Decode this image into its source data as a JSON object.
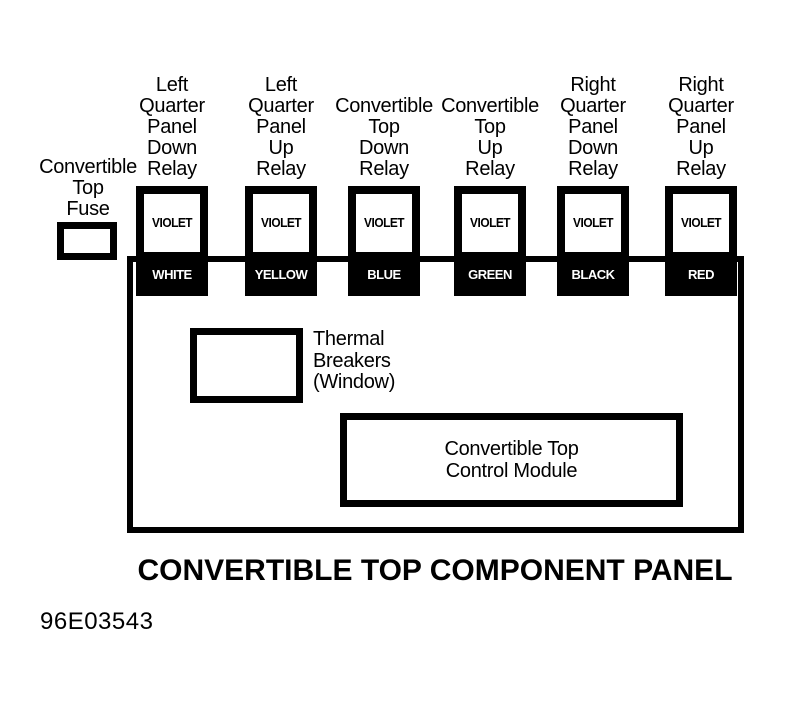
{
  "diagram": {
    "title": "CONVERTIBLE TOP COMPONENT PANEL",
    "figure_number": "96E03543",
    "colors": {
      "ink": "#000000",
      "paper": "#ffffff"
    },
    "fuse": {
      "label": "Convertible\nTop\nFuse"
    },
    "relays": [
      {
        "label": "Left\nQuarter\nPanel\nDown\nRelay",
        "top_text": "VIOLET",
        "band_text": "WHITE"
      },
      {
        "label": "Left\nQuarter\nPanel\nUp\nRelay",
        "top_text": "VIOLET",
        "band_text": "YELLOW"
      },
      {
        "label": "Convertible\nTop\nDown\nRelay",
        "top_text": "VIOLET",
        "band_text": "BLUE"
      },
      {
        "label": "Convertible\nTop\nUp\nRelay",
        "top_text": "VIOLET",
        "band_text": "GREEN"
      },
      {
        "label": "Right\nQuarter\nPanel\nDown\nRelay",
        "top_text": "VIOLET",
        "band_text": "BLACK"
      },
      {
        "label": "Right\nQuarter\nPanel\nUp\nRelay",
        "top_text": "VIOLET",
        "band_text": "RED"
      }
    ],
    "panel": {
      "thermal_breakers_label": "Thermal\nBreakers\n(Window)",
      "control_module_label": "Convertible Top\nControl Module"
    }
  }
}
